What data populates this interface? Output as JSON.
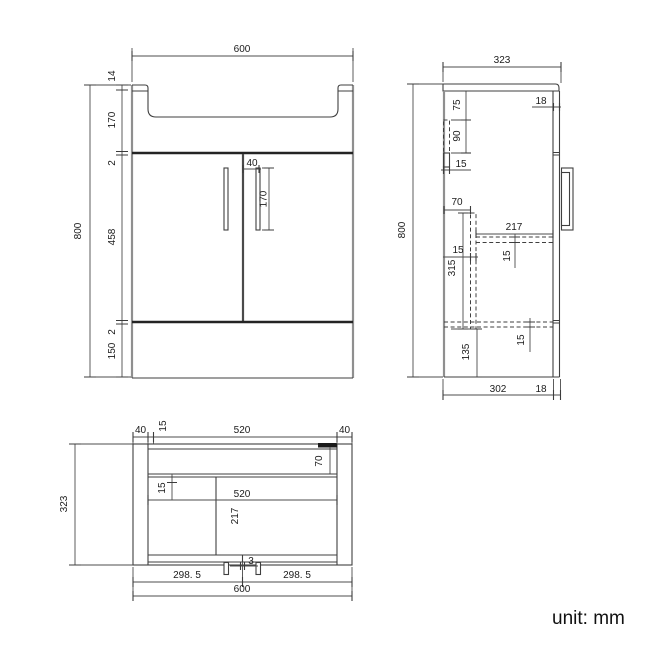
{
  "note": {
    "unit": "unit: mm"
  },
  "front": {
    "total_w": "600",
    "total_h": "800",
    "rim": "14",
    "basin": "170",
    "gap_top": "2",
    "doors": "458",
    "gap_bottom": "2",
    "plinth": "150",
    "handle_off": "40",
    "handle_len": "170"
  },
  "side": {
    "total_d": "323",
    "total_h": "800",
    "door_t_top": "18",
    "bracket_off": "75",
    "bracket_h": "90",
    "bracket_w": "15",
    "panel_off": "70",
    "shelf_d": "217",
    "panel_t": "15",
    "shelf_t": "15",
    "panel_h": "315",
    "bottom_t": "15",
    "plinth_h": "135",
    "body_d": "302",
    "door_t_bot": "18"
  },
  "plan": {
    "frame_l": "40",
    "back_t": "15",
    "inner_w_top": "520",
    "frame_r": "40",
    "rail_d": "70",
    "shelf_t": "15",
    "inner_w": "520",
    "part_d": "217",
    "total_d": "323",
    "door_l": "298. 5",
    "gap": "3",
    "door_r": "298. 5",
    "total_w": "600"
  }
}
